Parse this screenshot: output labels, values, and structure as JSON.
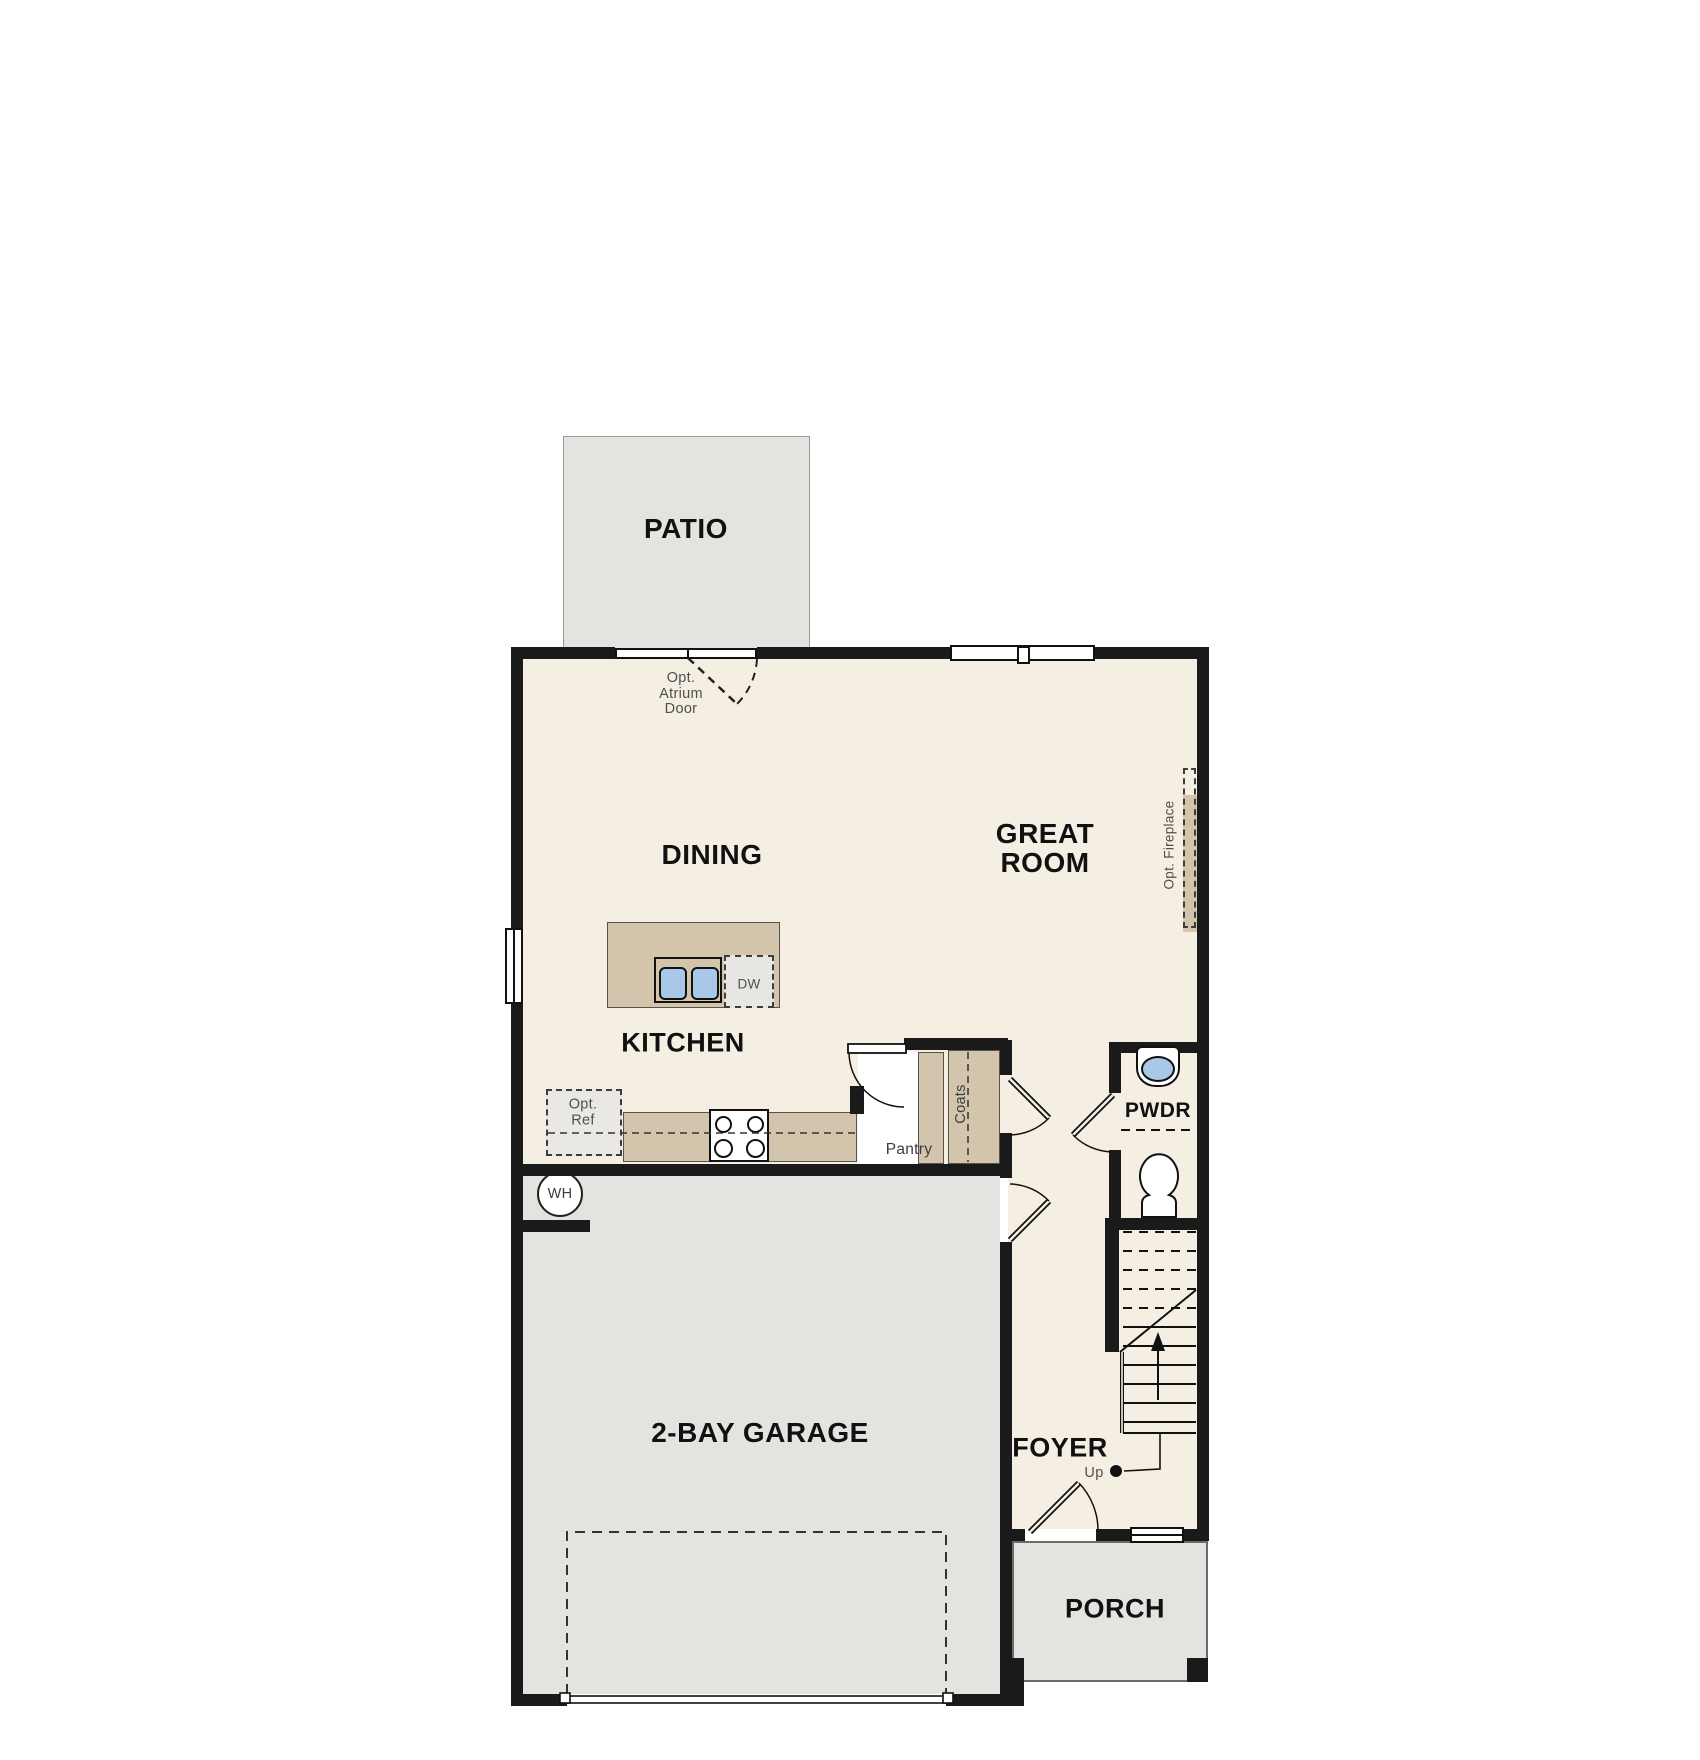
{
  "title": "First Floor Plan",
  "colors": {
    "floor": "#f5efe3",
    "outdoor_concrete": "#e5e3e0",
    "cabinetry_tan": "#d2c5ac",
    "wall_black": "#1a1a1a",
    "sink_blue": "#a9c7e7"
  },
  "rooms": {
    "patio": "PATIO",
    "dining": "DINING",
    "great_room_line1": "GREAT",
    "great_room_line2": "ROOM",
    "kitchen": "KITCHEN",
    "powder": "PWDR",
    "garage": "2-BAY GARAGE",
    "foyer": "FOYER",
    "porch": "PORCH"
  },
  "annotations": {
    "atrium_line1": "Opt.",
    "atrium_line2": "Atrium",
    "atrium_line3": "Door",
    "fireplace": "Opt. Fireplace",
    "ref_line1": "Opt.",
    "ref_line2": "Ref",
    "dishwasher": "DW",
    "pantry": "Pantry",
    "coats": "Coats",
    "water_heater": "WH",
    "up": "Up"
  }
}
